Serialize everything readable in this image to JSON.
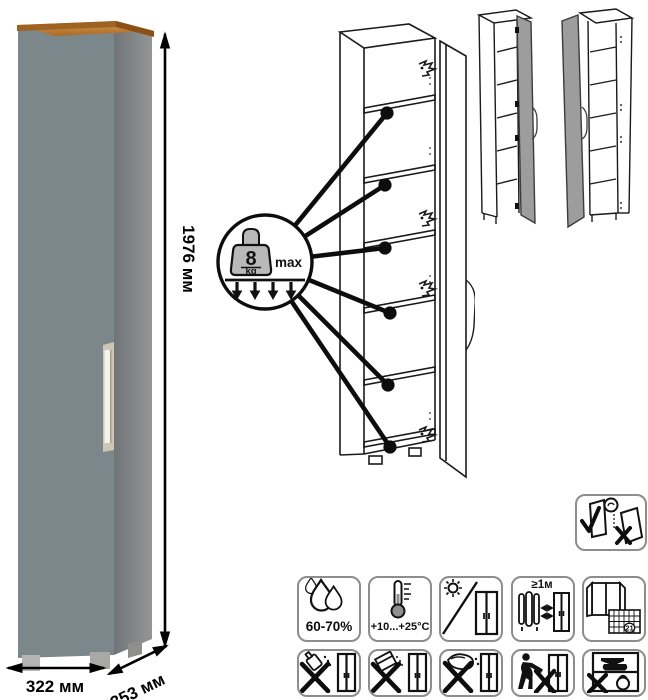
{
  "product_photo": {
    "height_label": "1976 мм",
    "width_label": "322 мм",
    "depth_label": "353 мм",
    "colors": {
      "front": "#7c878b",
      "side_dark": "#717578",
      "side_light": "#939695",
      "wood": "#a96a22",
      "wood_light": "#d89c55",
      "handle": "#f4f3ec",
      "handle_recess": "#cfc7b5"
    }
  },
  "load_callout": {
    "value": "8",
    "unit": "kg",
    "max_label": "max"
  },
  "assembly_views": {
    "main": "open-cabinet-line-drawing",
    "variants": [
      "door-hinged-right-view",
      "door-hinged-left-view"
    ],
    "notice": "transport-doors-upright-notice"
  },
  "care_icons": {
    "row1": [
      {
        "name": "humidity-range-icon",
        "label": "60-70%"
      },
      {
        "name": "temperature-range-icon",
        "label": "+10...+25°C"
      },
      {
        "name": "avoid-direct-sunlight-icon",
        "label": ""
      },
      {
        "name": "min-distance-from-heat-icon",
        "label": "≥1м"
      },
      {
        "name": "ventilation-calendar-icon",
        "label": "21"
      }
    ],
    "row2": [
      {
        "name": "no-solvents-icon"
      },
      {
        "name": "no-abrasive-powder-icon"
      },
      {
        "name": "no-wet-cloth-icon"
      },
      {
        "name": "no-dragging-icon"
      },
      {
        "name": "no-overloading-icon"
      }
    ]
  }
}
